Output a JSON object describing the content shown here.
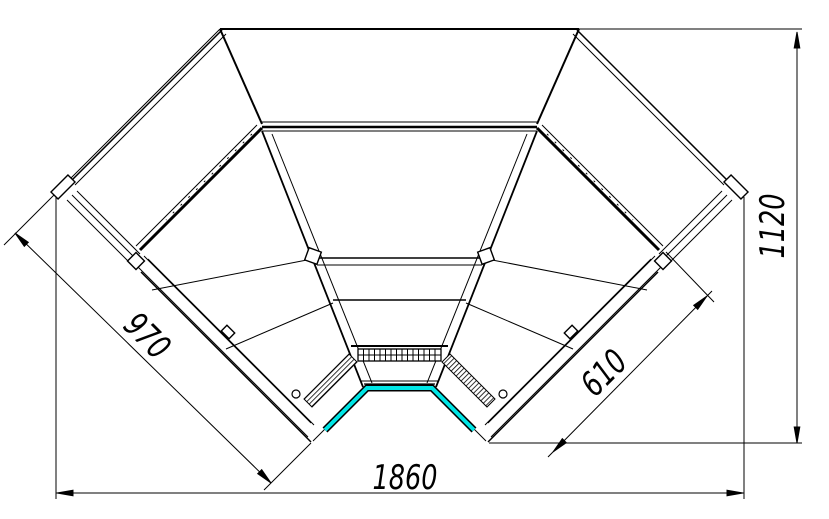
{
  "drawing": {
    "title": "corner-display-case-technical-drawing",
    "dimensions": {
      "left_front_length": "970",
      "right_overall_depth": "1120",
      "bottom_overall_width": "1860",
      "right_end_depth": "610"
    },
    "colors": {
      "line": "#000000",
      "background": "#ffffff",
      "bumper_accent": "#00e5e5"
    }
  }
}
